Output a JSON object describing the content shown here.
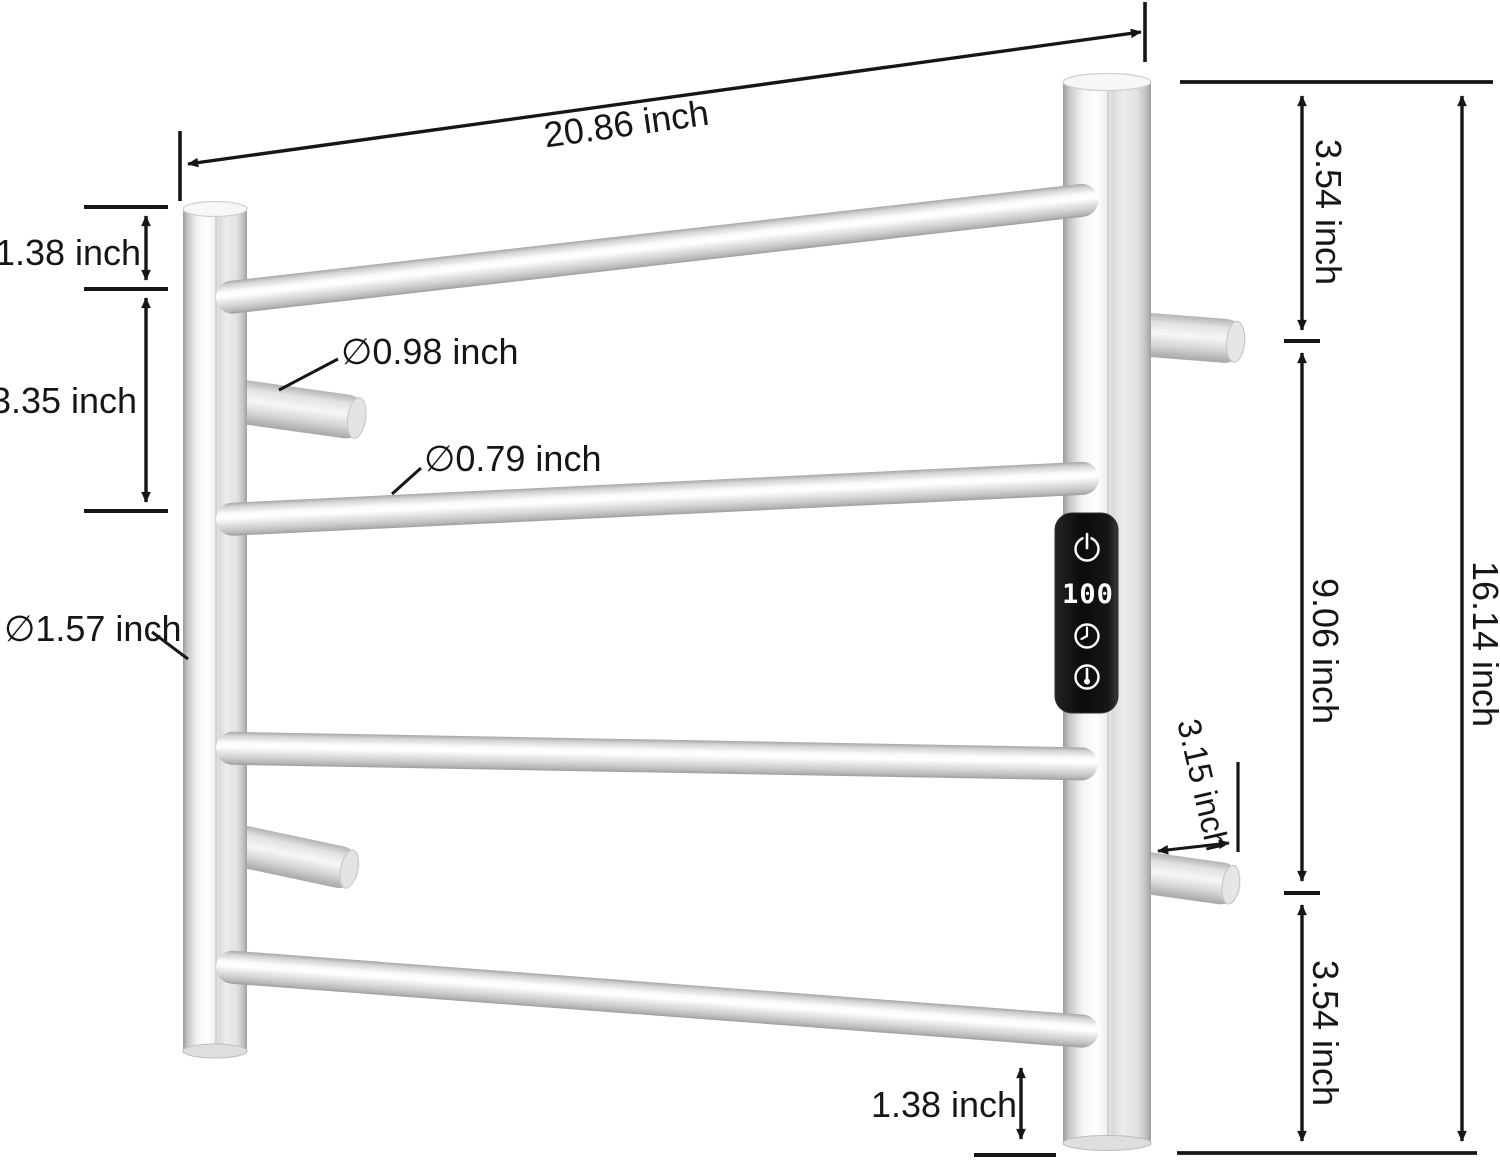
{
  "diagram": {
    "units": "inch",
    "labels": {
      "overall_width": "20.86 inch",
      "top_rail_offset": "1.38 inch",
      "rail_spacing": "3.35 inch",
      "hook_diameter": "∅0.98 inch",
      "rail_diameter": "∅0.79 inch",
      "post_diameter": "∅1.57 inch",
      "right_top_section": "3.54 inch",
      "right_middle_section": "9.06 inch",
      "overall_height": "16.14 inch",
      "bracket_depth": "3.15 inch",
      "bottom_rail_offset": "1.38 inch",
      "right_bottom_section": "3.54 inch"
    },
    "control_panel": {
      "display_value": "100",
      "buttons": [
        "power",
        "timer",
        "temperature"
      ]
    },
    "colors": {
      "dimension_line": "#161616",
      "panel_background": "#101010",
      "display_text": "#ffffff",
      "background": "#ffffff"
    }
  }
}
